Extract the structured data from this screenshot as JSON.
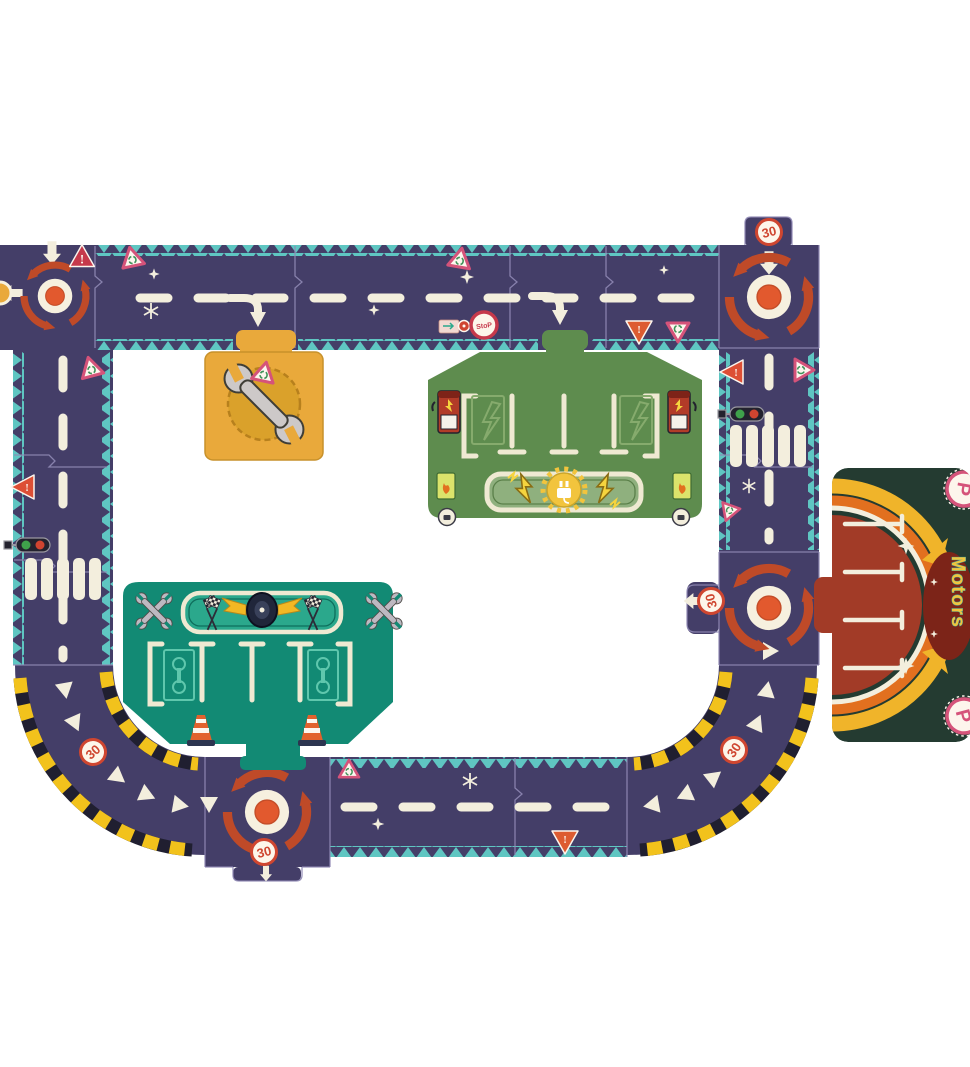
{
  "scene": {
    "kind": "toy-road-circuit-puzzle",
    "background": "#ffffff"
  },
  "palette": {
    "background": "#ffffff",
    "road": "#443e68",
    "teeth": "#5fc6c2",
    "seam": "#8f88b4",
    "cream": "#f3eedd",
    "arrowRed": "#bf4a28",
    "centerDot": "#e2592e",
    "signRed": "#cf4630",
    "crimson": "#c6394b",
    "warnOrange": "#dd5c31",
    "pink": "#d5537a",
    "glyphGreen": "#3f9159",
    "hazardYellow": "#f2c21c",
    "hazardDark": "#201f30",
    "tileOrange": "#e9a93b",
    "tileGold": "#daa12b",
    "stationGreen": "#5e8c4e",
    "stationLine": "#efe9d2",
    "pumpRed": "#b23b28",
    "garageTeal": "#128a74",
    "bannerTeal": "#2ba88c",
    "bayTeal": "#5fc7ad",
    "wingYellow": "#f2b824",
    "coneOrange": "#e2622d",
    "motorsDark": "#243b31",
    "motorsRed": "#a23b27",
    "rainbowOrange": "#e2701f",
    "rainbowYellow": "#f0b42a",
    "motorsText": "#f2c43d",
    "motorsTextEdge": "#35aca2",
    "lightGreen": "#3fa14b",
    "lightRed": "#cf4430",
    "wrenchGray": "#bdb9c1"
  },
  "labels": {
    "speed_limit": "30",
    "stop": "StoP",
    "motors": "Motors",
    "parking": "P",
    "warning": "!"
  },
  "icons": {
    "roundabout": "red circular arrows",
    "wrench": "repair wrench",
    "crossed-wrenches": "garage corner emblem",
    "charging-pump": "red pump with lightning bolt",
    "plug-sunburst": "charging station emblem",
    "winged-tire": "pit-stop emblem",
    "checkered-flags": "race flags",
    "traffic-light": "green and red horizontal signal",
    "crosswalk": "white zebra bars",
    "cone": "traffic cone",
    "hazard-stripes": "yellow-black curve edging",
    "sparkle": "white star glint"
  }
}
